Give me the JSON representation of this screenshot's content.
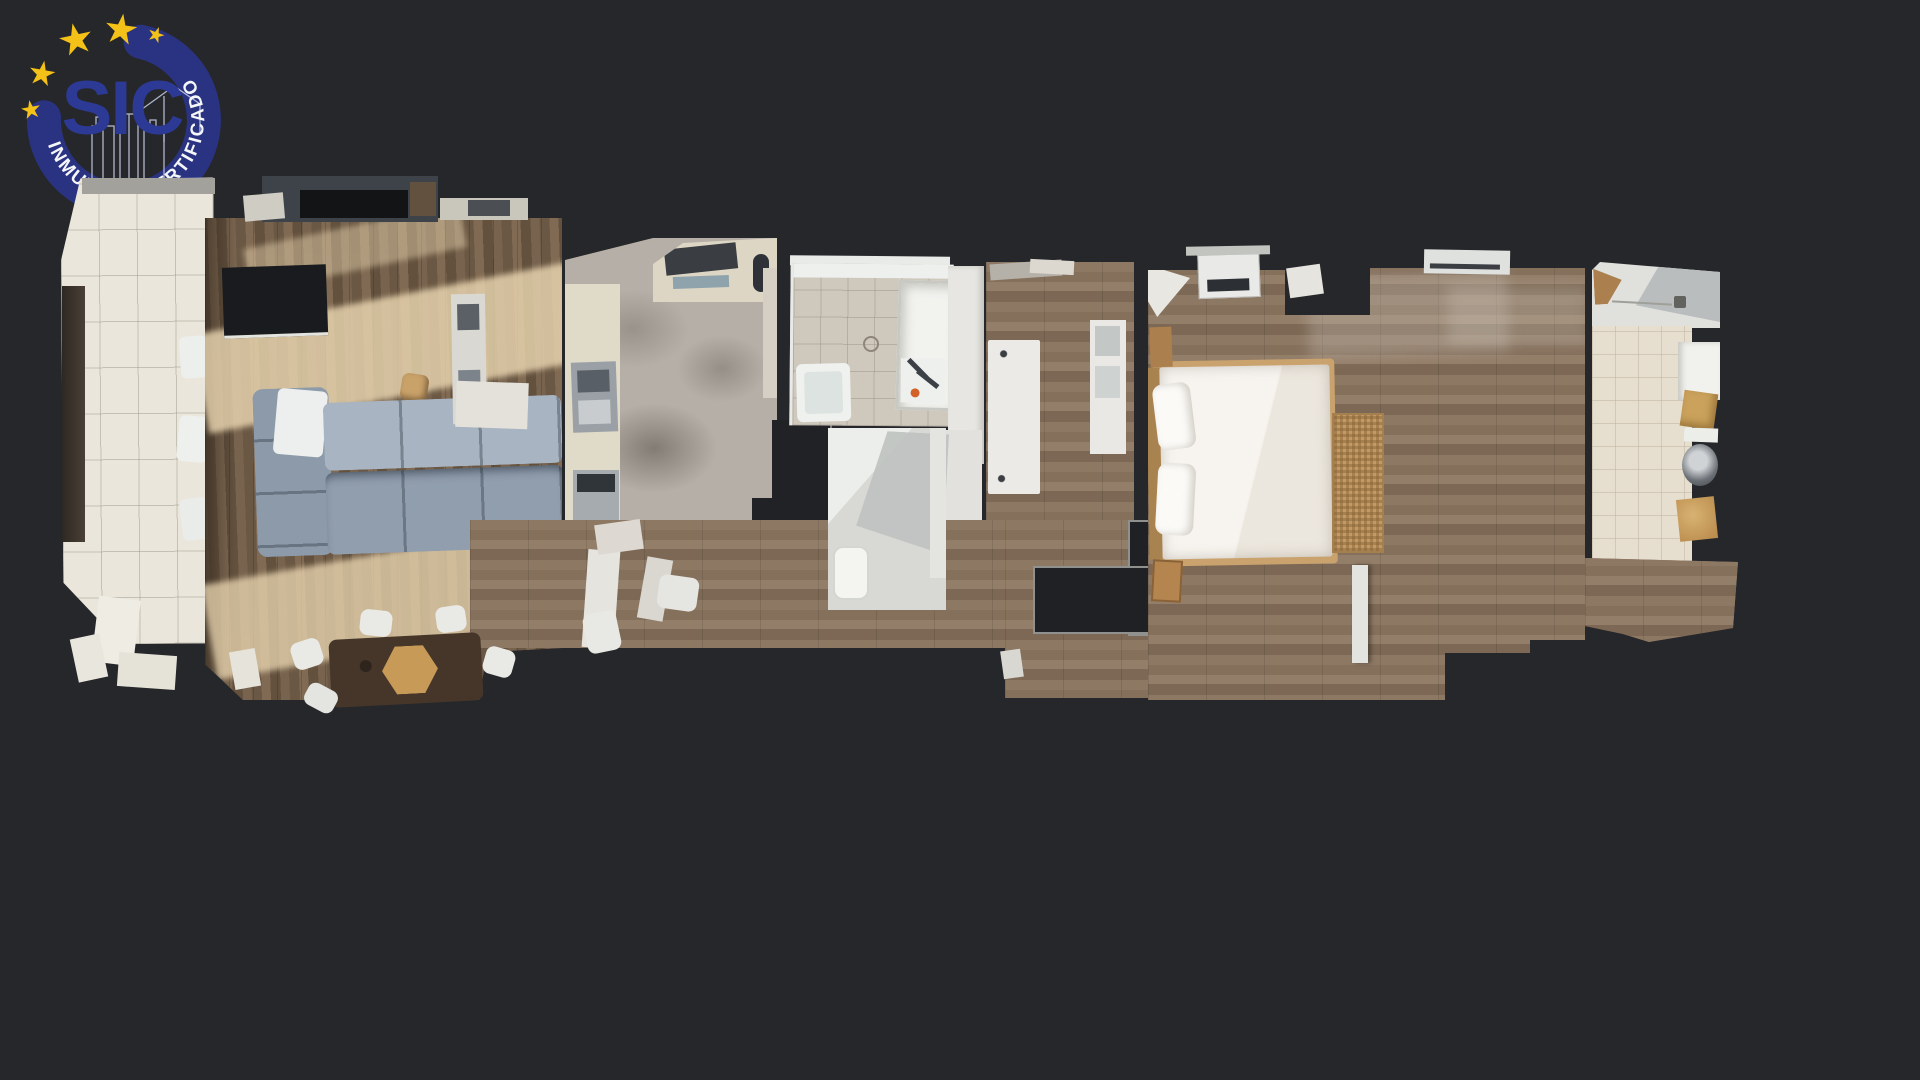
{
  "page": {
    "background_color": "#26272b",
    "content_type": "top-down 3D dollhouse floor plan scan of an apartment on a dark backdrop"
  },
  "logo": {
    "acronym": "SIC",
    "ring_text": "INMUEBLE CERTIFICADO",
    "star_count": 5,
    "colors": {
      "navy": "#2a3382",
      "acronym_navy": "#2c3a96",
      "gold": "#f3c117",
      "text_white": "#f5f6fa",
      "line_art": "#c9cfe8"
    }
  },
  "floorplan": {
    "areas": [
      "terrace",
      "living-dining-room",
      "kitchen",
      "bathroom",
      "guest-bathroom",
      "hallway",
      "corridor-wardrobe",
      "master-bedroom",
      "utility-bathroom"
    ],
    "palette": {
      "wood_floor": "#7c6753",
      "wood_floor_light": "#8d7864",
      "sunlight_patch": "#ecd8b2",
      "terrace_tile": "#eae6db",
      "kitchen_floor": "#b6afa7",
      "bathroom_tile": "#cfc8bd",
      "sofa_gray": "#9aa7b5",
      "bed_linen": "#f3f0ea",
      "rug_tan": "#c39a66",
      "counter_cream": "#e0dac9",
      "wall_void": "#1f2124"
    }
  }
}
